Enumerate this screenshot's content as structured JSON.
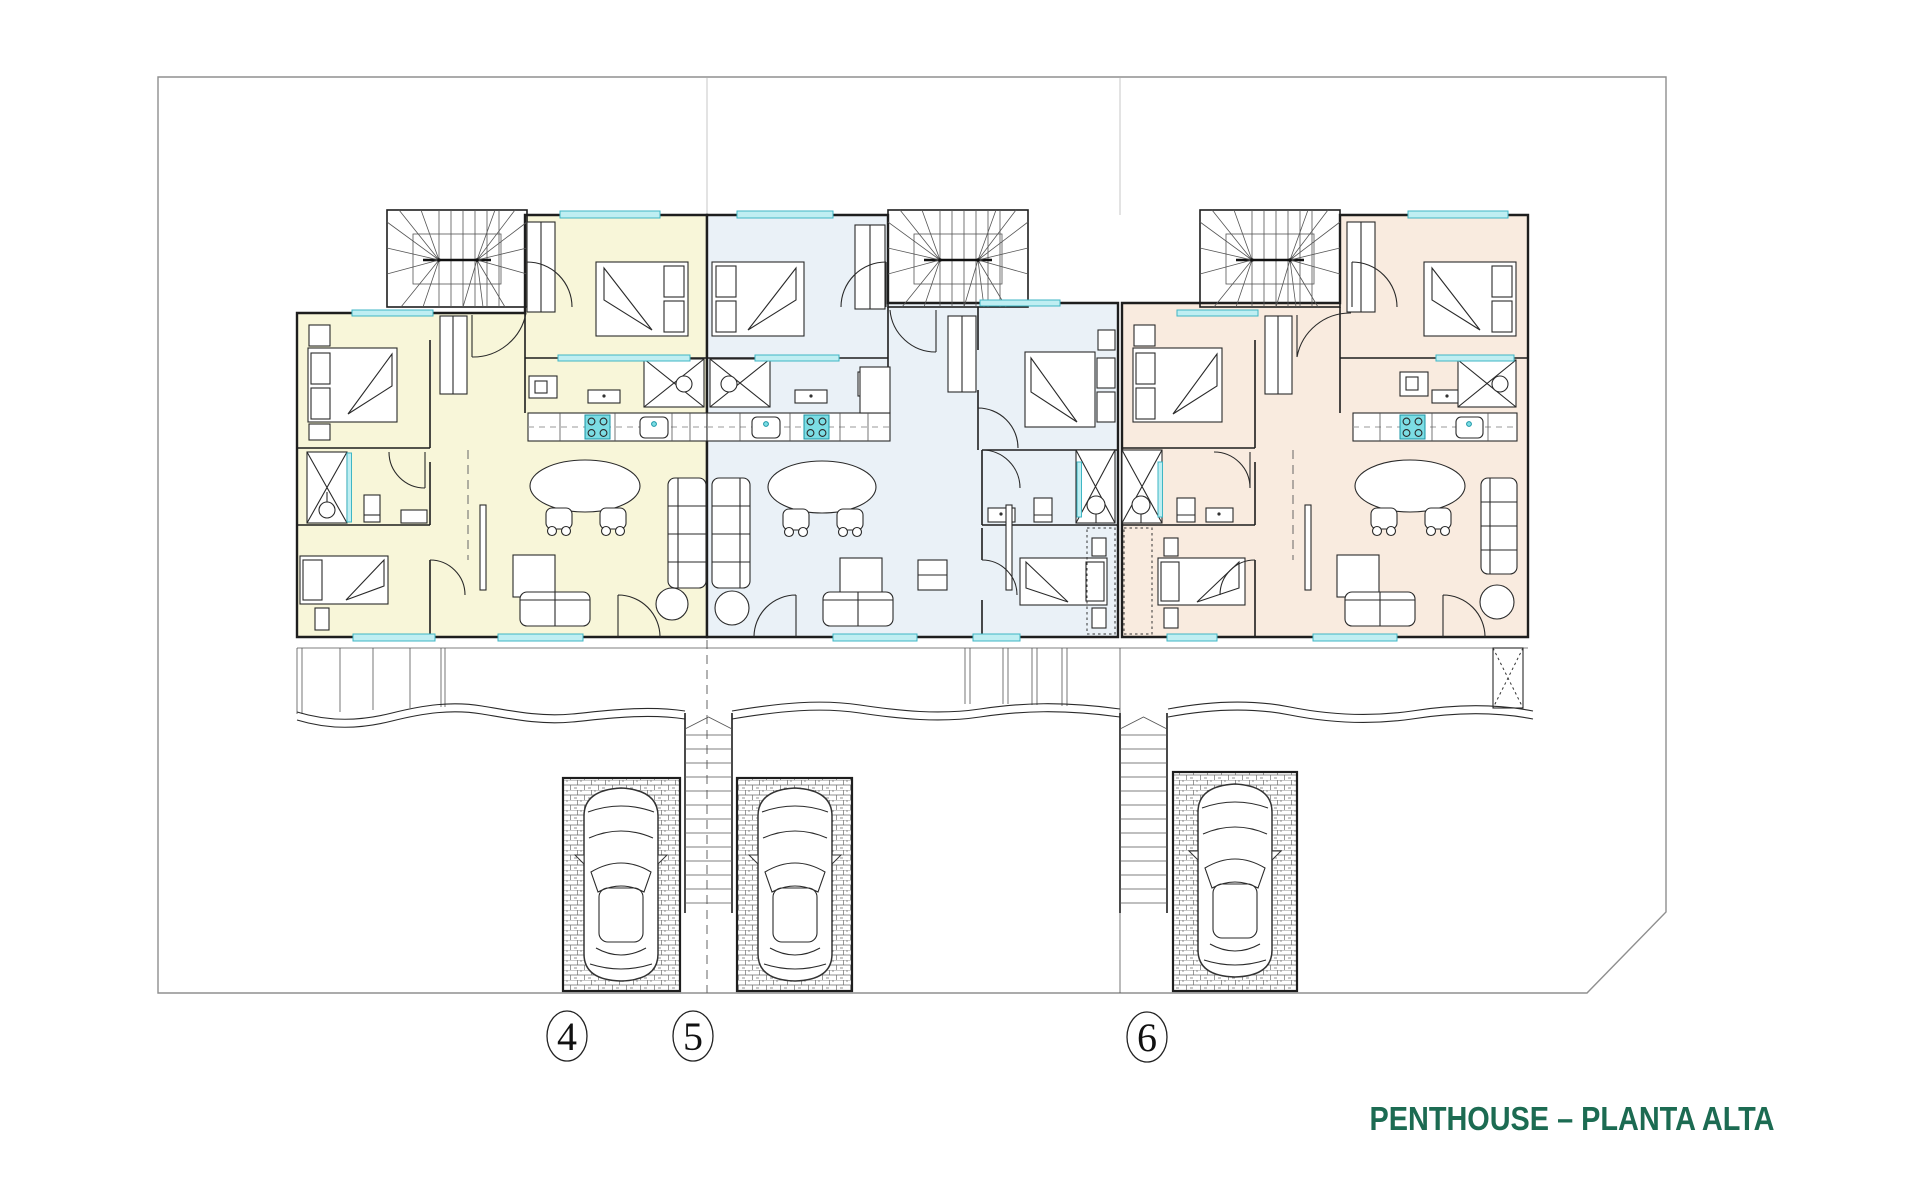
{
  "title": {
    "text": "PENTHOUSE – PLANTA ALTA",
    "color": "#1c6b52"
  },
  "units": [
    {
      "number": "4",
      "fill": "#f8f6d9"
    },
    {
      "number": "5",
      "fill": "#eaf1f7"
    },
    {
      "number": "6",
      "fill": "#f9ebdf"
    }
  ],
  "palette": {
    "wall": "#1e1e1e",
    "furniture": "#2a2a2a",
    "boundary": "#8f8f8f",
    "window_fill": "#bfeef2",
    "window_stroke": "#3fb6c4",
    "fixture_fill": "#7cdde4",
    "fixture_stroke": "#1894a5"
  }
}
